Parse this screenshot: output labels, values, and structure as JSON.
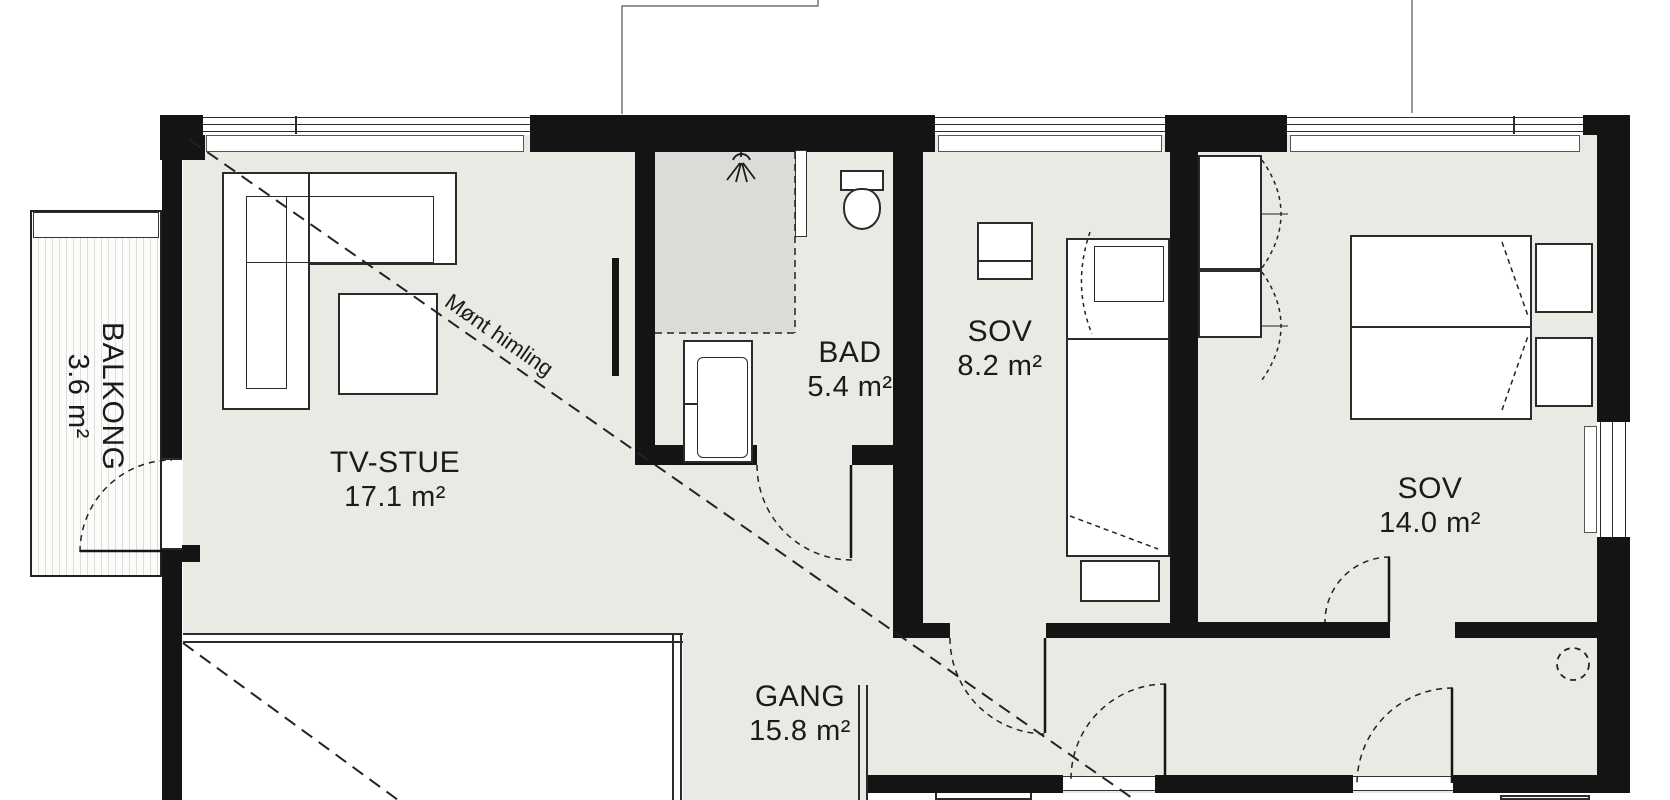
{
  "plan": {
    "rooms": {
      "balcony": {
        "name": "BALKONG",
        "area": "3.6 m²"
      },
      "tv_room": {
        "name": "TV-STUE",
        "area": "17.1 m²"
      },
      "bathroom": {
        "name": "BAD",
        "area": "5.4 m²"
      },
      "bedroom_small": {
        "name": "SOV",
        "area": "8.2 m²"
      },
      "bedroom_large": {
        "name": "SOV",
        "area": "14.0 m²"
      },
      "hallway": {
        "name": "GANG",
        "area": "15.8 m²"
      }
    },
    "ceiling_annotation": "Mønt himling",
    "colors": {
      "wall": "#141414",
      "floor": "#eae9e4",
      "shower_floor": "#dcdbd7"
    }
  }
}
